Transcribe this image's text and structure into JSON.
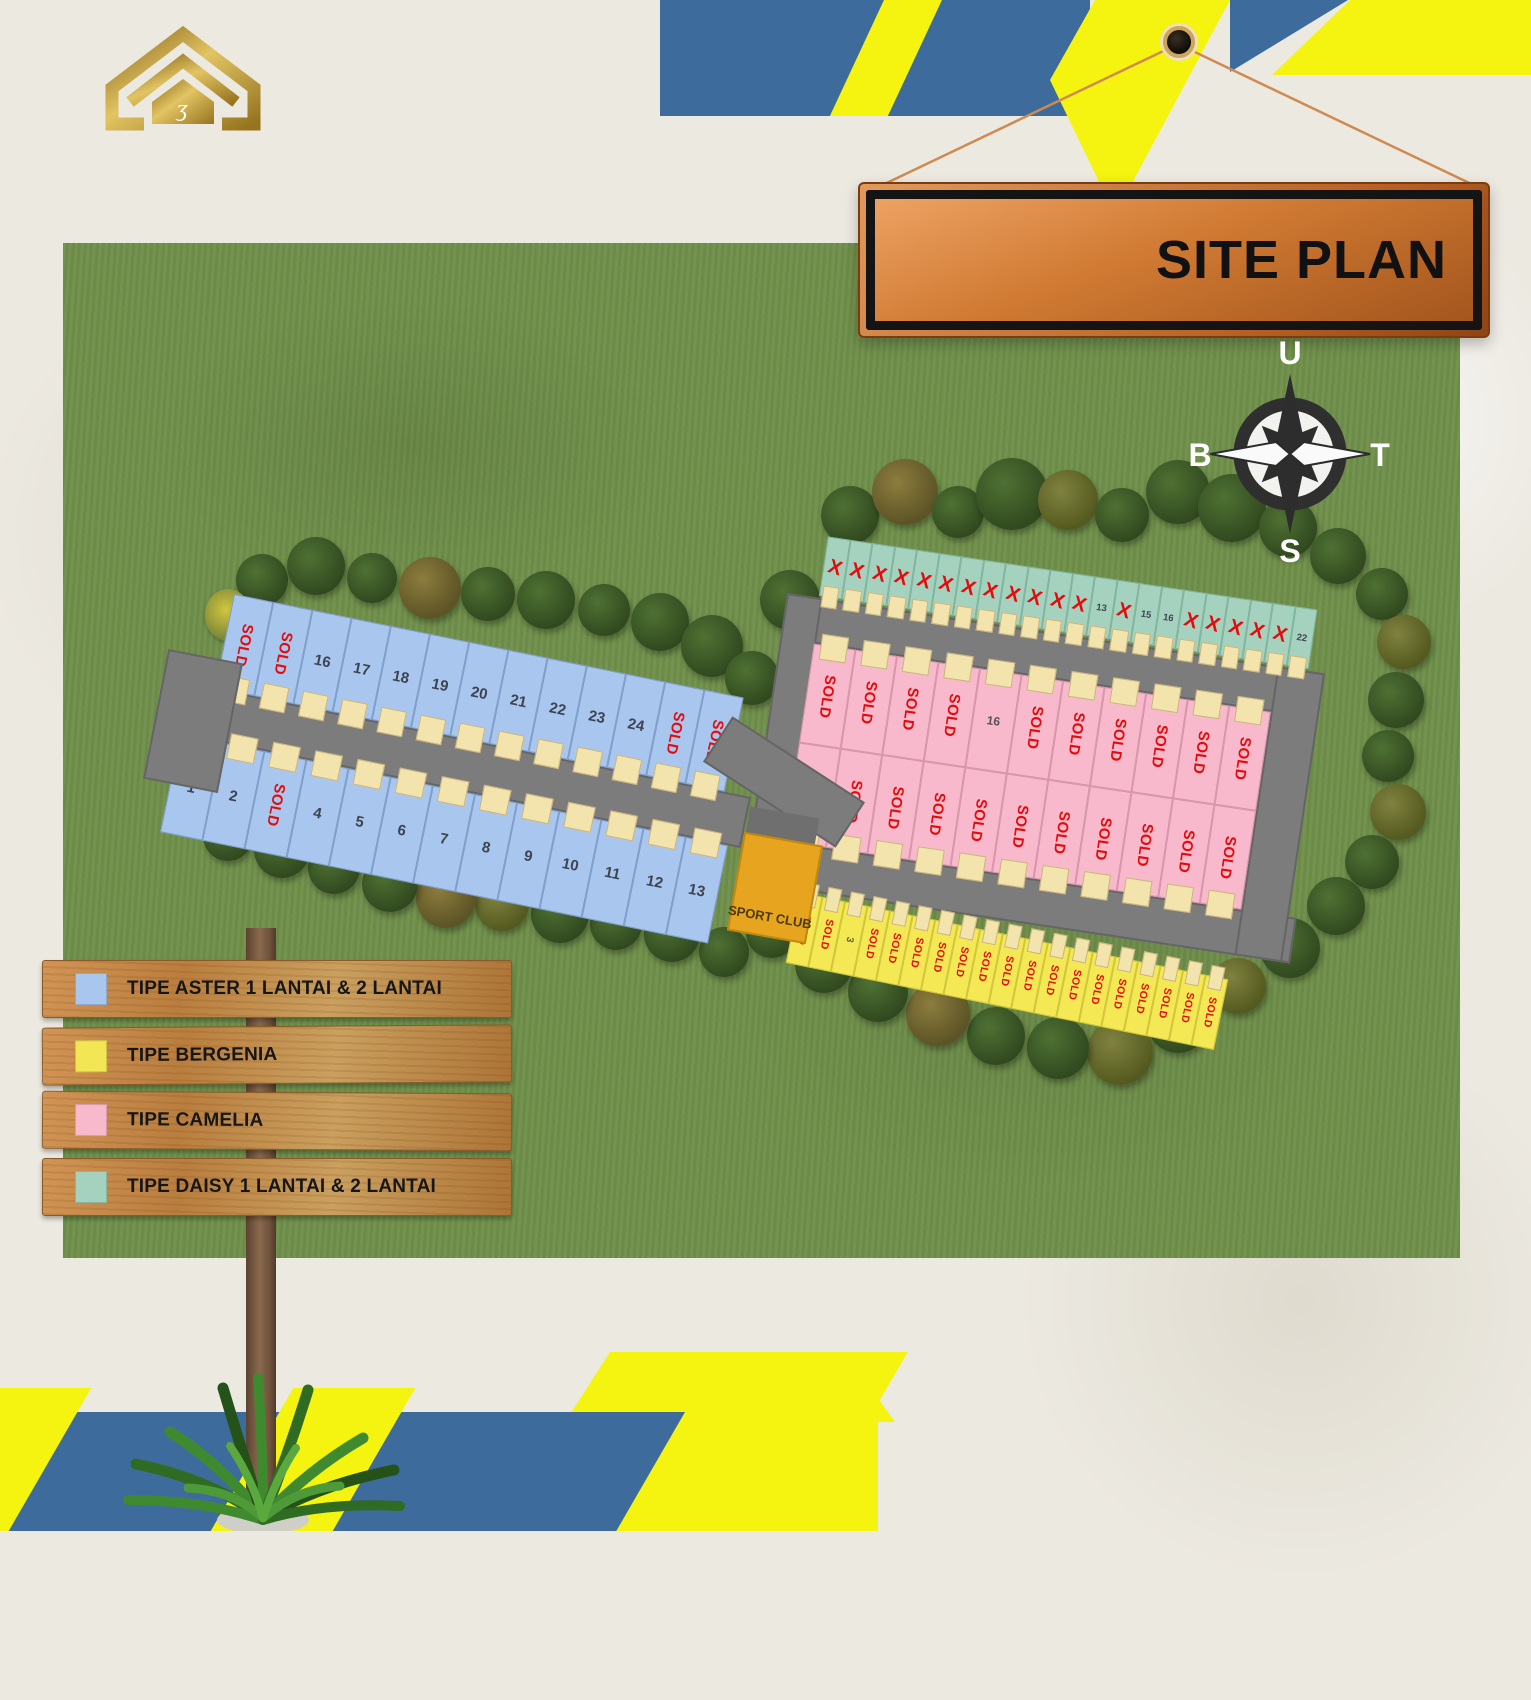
{
  "branding": {
    "logo_icon": "gold-house-icon"
  },
  "sign": {
    "title": "SITE PLAN"
  },
  "compass": {
    "north": "U",
    "east": "T",
    "south": "S",
    "west": "B"
  },
  "legend": {
    "items": [
      {
        "label": "TIPE ASTER 1 LANTAI & 2 LANTAI",
        "color": "#a9c6ee"
      },
      {
        "label": "TIPE BERGENIA",
        "color": "#f2e654"
      },
      {
        "label": "TIPE CAMELIA",
        "color": "#f7b9cb"
      },
      {
        "label": "TIPE DAISY 1 LANTAI & 2 LANTAI",
        "color": "#a5d2bf"
      }
    ]
  },
  "site": {
    "sport_club_label": "SPORT CLUB",
    "sold_label": "SOLD",
    "x_label": "X",
    "rows": {
      "aster_top": [
        "SOLD",
        "SOLD",
        "16",
        "17",
        "18",
        "19",
        "20",
        "21",
        "22",
        "23",
        "24",
        "SOLD",
        "SOLD"
      ],
      "aster_bottom": [
        "1",
        "2",
        "SOLD",
        "4",
        "5",
        "6",
        "7",
        "8",
        "9",
        "10",
        "11",
        "12",
        "13"
      ],
      "daisy": [
        "X",
        "X",
        "X",
        "X",
        "X",
        "X",
        "X",
        "X",
        "X",
        "X",
        "X",
        "X",
        "13",
        "X",
        "15",
        "16",
        "X",
        "X",
        "X",
        "X",
        "X",
        "22"
      ],
      "camelia_top": [
        "SOLD",
        "SOLD",
        "SOLD",
        "SOLD",
        "16",
        "SOLD",
        "SOLD",
        "SOLD",
        "SOLD",
        "SOLD",
        "SOLD"
      ],
      "camelia_bottom": [
        "SOLD",
        "SOLD",
        "SOLD",
        "SOLD",
        "SOLD",
        "SOLD",
        "SOLD",
        "SOLD",
        "SOLD",
        "SOLD",
        "SOLD"
      ],
      "bergenia": [
        "SOLD",
        "SOLD",
        "3",
        "SOLD",
        "SOLD",
        "SOLD",
        "SOLD",
        "SOLD",
        "SOLD",
        "SOLD",
        "SOLD",
        "SOLD",
        "SOLD",
        "SOLD",
        "SOLD",
        "SOLD",
        "SOLD",
        "SOLD",
        "SOLD"
      ]
    },
    "colors": {
      "aster": "#a9c6ee",
      "bergenia": "#f4e954",
      "camelia": "#f7b9cb",
      "daisy": "#a5d2bf",
      "sold_red": "#e30b0b",
      "road": "#7c7c7c",
      "grass": "#70904a",
      "sign_orange": "#cf7a35"
    }
  }
}
